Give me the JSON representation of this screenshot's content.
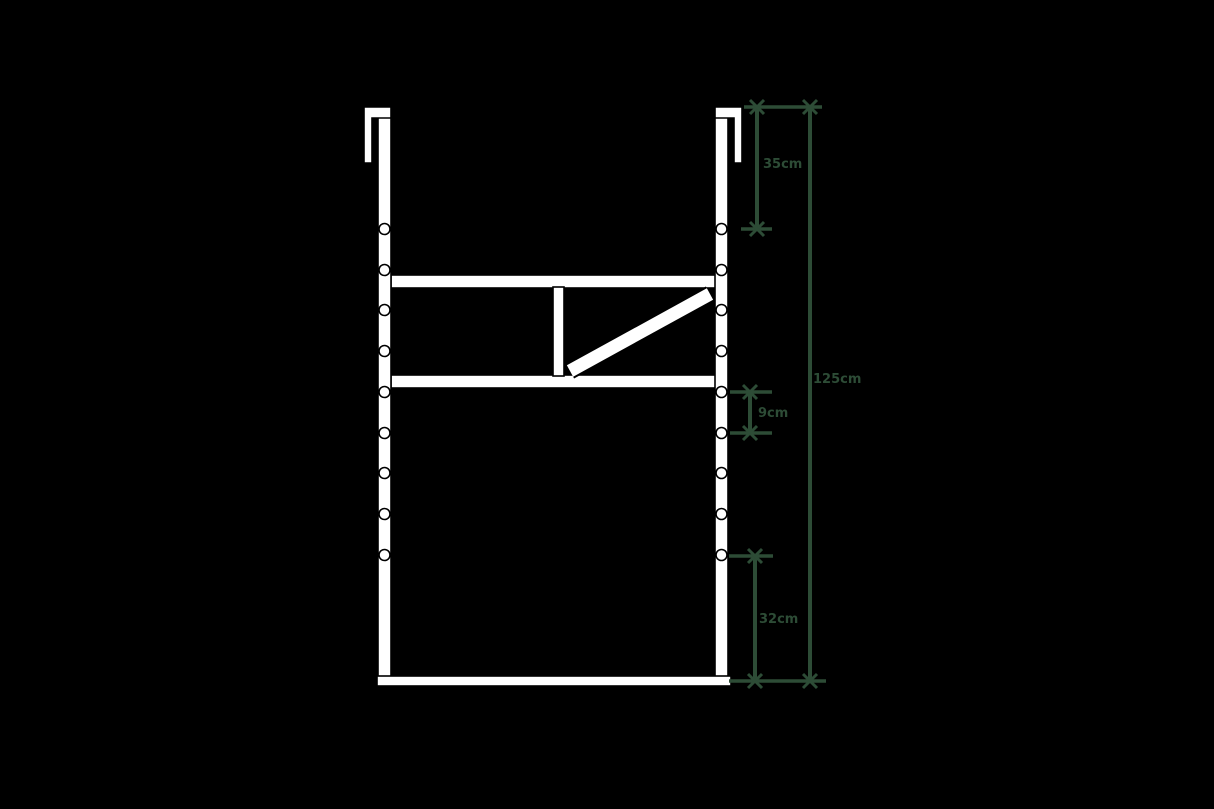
{
  "diagram": {
    "background_color": "#000000",
    "structure_fill_color": "#ffffff",
    "structure_outline_color": "#000000",
    "dimension_color": "#2d4c36",
    "holes_per_post": 9,
    "dimensions": {
      "top_segment_label": "35cm",
      "middle_segment_label": "9cm",
      "bottom_segment_label": "32cm",
      "total_height_label": "125cm"
    }
  }
}
